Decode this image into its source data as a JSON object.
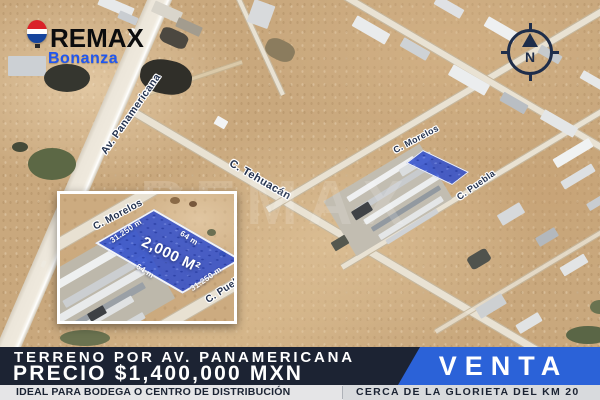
{
  "brand": {
    "name": "REMAX",
    "office": "Bonanza"
  },
  "compass": {
    "label": "N"
  },
  "watermark": {
    "text": "REMAX"
  },
  "map": {
    "streets": {
      "panamericana": "Av. Panamericana",
      "tehuacan": "C. Tehuacán",
      "morelos": "C. Morelos",
      "puebla": "C. Puebla"
    }
  },
  "inset": {
    "streets": {
      "morelos": "C. Morelos",
      "puebla": "C. Puebla"
    },
    "area_label": "2,000 M²",
    "dimensions": {
      "top": "64 m",
      "bottom": "64 m",
      "left": "31.250 m",
      "right": "31.250 m"
    }
  },
  "banner": {
    "title": "TERRENO POR AV. PANAMERICANA",
    "price": "PRECIO $1,400,000 MXN",
    "badge": "VENTA",
    "note_left": "IDEAL PARA BODEGA O CENTRO DE DISTRIBUCIÓN",
    "note_right": "CERCA DE LA GLORIETA DEL KM 20"
  },
  "colors": {
    "banner_navy": "#1c2333",
    "venta_blue": "#2b62d8",
    "parcel_blue": "#2f4dce",
    "street_label_navy": "#25334f",
    "bonanza_blue": "#2156ee",
    "sand": "#c9a87d"
  }
}
